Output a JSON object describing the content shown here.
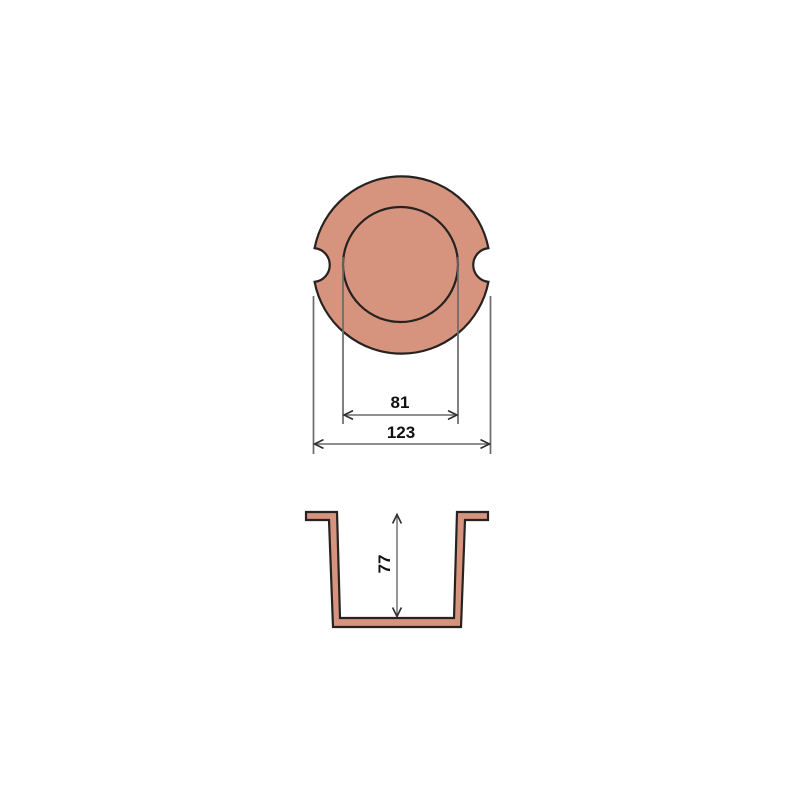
{
  "drawing": {
    "type": "technical-drawing",
    "part": "cable-grommet",
    "top_view": {
      "inner_diameter": "81",
      "outer_diameter": "123"
    },
    "side_view": {
      "height": "77"
    },
    "colors": {
      "part_fill": "#d6937e",
      "part_outline": "#262220",
      "dimension_line": "#6a6a6a",
      "arrowhead": "#2e2e2e",
      "text": "#111111",
      "background": "#ffffff"
    }
  }
}
